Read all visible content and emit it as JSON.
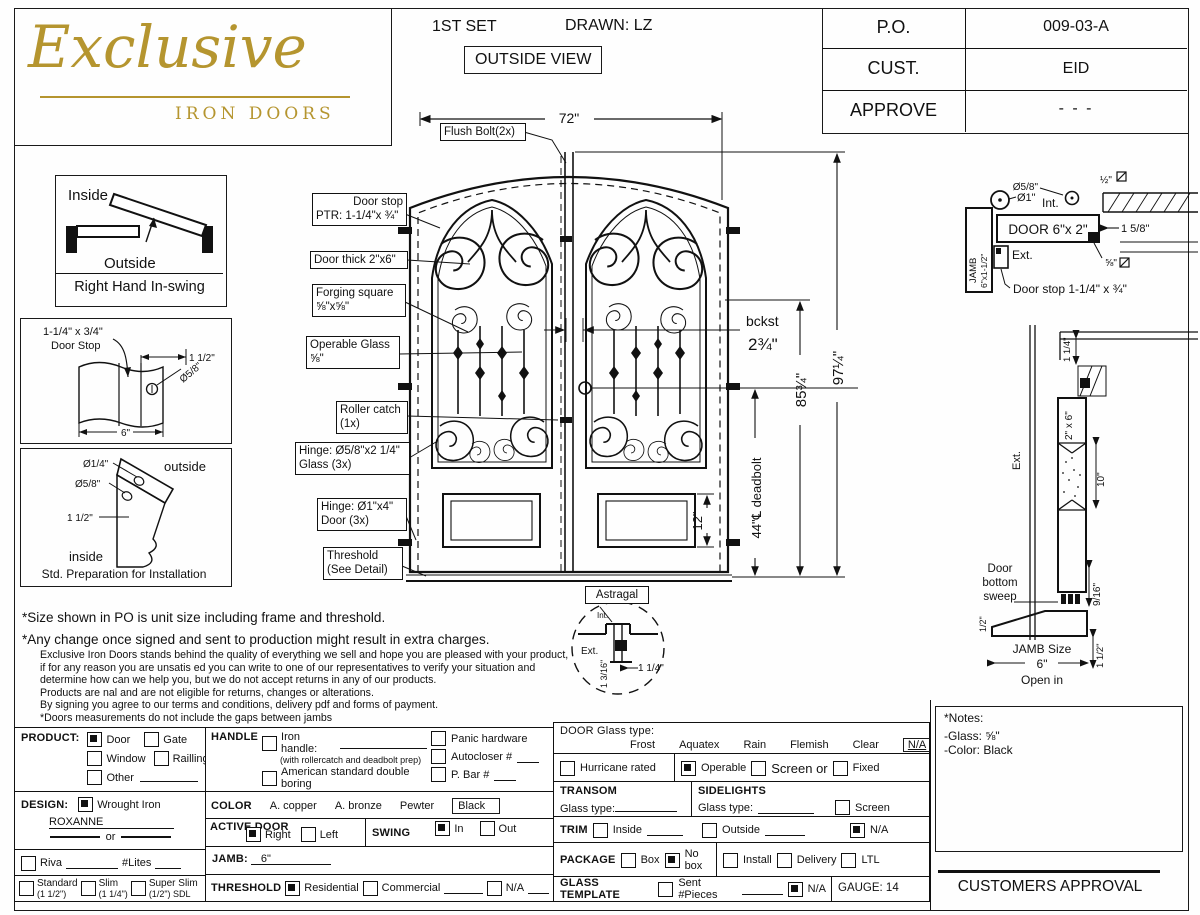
{
  "header": {
    "logo_line1": "Exclusive",
    "logo_line2": "IRON DOORS",
    "set_label": "1ST SET",
    "drawn_label": "DRAWN: LZ",
    "view_label": "OUTSIDE VIEW",
    "table": {
      "r1_label": "P.O.",
      "r1_value": "009-03-A",
      "r2_label": "CUST.",
      "r2_value": "EID",
      "r3_label": "APPROVE",
      "r3_value": "- - -"
    }
  },
  "swing_box": {
    "inside": "Inside",
    "outside": "Outside",
    "caption": "Right Hand In-swing"
  },
  "doorstop_detail": {
    "line1": "1-1/4\" x 3/4\"",
    "line2": "Door Stop",
    "dim_height": "1 1/2\"",
    "dim_hole": "Ø5/8\"",
    "dim_width": "6\""
  },
  "install_detail": {
    "dim1": "Ø1/4\"",
    "dim2": "Ø5/8\"",
    "dim3": "1 1/2\"",
    "outside": "outside",
    "inside": "inside",
    "caption": "Std. Preparation for Installation"
  },
  "door": {
    "labels": {
      "flush_bolt": "Flush Bolt(2x)",
      "door_stop1": "Door stop",
      "door_stop2": "PTR: 1-1/4\"x ¾\"",
      "door_thick": "Door thick 2\"x6\"",
      "forging1": "Forging square",
      "forging2": "⅝\"x⅝\"",
      "operable1": "Operable Glass",
      "operable2": "⅝\"",
      "roller1": "Roller catch",
      "roller2": "(1x)",
      "hinge_glass1": "Hinge: Ø5/8\"x2 1/4\"",
      "hinge_glass2": "Glass (3x)",
      "hinge_door1": "Hinge: Ø1\"x4\"",
      "hinge_door2": "Door (3x)",
      "threshold1": "Threshold",
      "threshold2": "(See Detail)",
      "astragal": "Astragal"
    },
    "dims": {
      "width": "72\"",
      "height_unit": "97¼\"",
      "height_door": "85¾\"",
      "deadbolt": "44\"℄ deadbolt",
      "panel": "12\"",
      "backset1": "bckst",
      "backset2": "2¾\""
    },
    "astragal_detail": {
      "int": "Int.",
      "ext": "Ext.",
      "dim_v": "1 3/16\"",
      "dim_h": "1 1/4\""
    }
  },
  "head_detail": {
    "hinge_dia": "Ø1\"",
    "int": "Int.",
    "peep": "Ø5/8\"",
    "half": "½\"",
    "door_label": "DOOR 6\"x 2\"",
    "dim": "1 5/8\"",
    "seal": "⅝\"",
    "jamb1": "JAMB",
    "jamb2": "6\"x1-1/2\"",
    "ext": "Ext.",
    "door_stop": "Door stop 1-1/4\" x ¾\""
  },
  "section_detail": {
    "top_dim": "1 1/4\"",
    "door_dim": "2\" x 6\"",
    "glass_dim": "10\"",
    "ext": "Ext.",
    "sweep_dim": "9/16\"",
    "sweep1": "Door",
    "sweep2": "bottom",
    "sweep3": "sweep",
    "half": "1/2\"",
    "jamb_size1": "JAMB Size",
    "jamb_size2": "6\"",
    "open_in": "Open in",
    "threshold_h": "1 1/2\""
  },
  "notes": {
    "line1": "*Size shown in PO is unit size including frame and threshold.",
    "line2": "*Any change once signed and sent to production might result in extra charges.",
    "body": [
      "Exclusive Iron Doors stands behind the quality of everything we sell and hope you are pleased with your product,",
      "if for any reason you are unsatis  ed you can write to one of our representatives to verify your situation and",
      "determine how can we help you, but we do not accept returns in any of our products.",
      "Products are  nal and are not eligible for returns, changes or alterations.",
      "By signing you agree to our terms and conditions, delivery pdf and forms of payment.",
      "*Doors measurements do not include the gaps between jambs"
    ]
  },
  "form": {
    "product": {
      "label": "PRODUCT:",
      "door": "Door",
      "gate": "Gate",
      "window": "Window",
      "railling": "Railling",
      "other": "Other"
    },
    "design": {
      "label": "DESIGN:",
      "opt": "Wrought Iron",
      "name": "ROXANNE",
      "or": "or"
    },
    "riva": {
      "label": "Riva",
      "lites": "#Lites"
    },
    "sdl": {
      "standard1": "Standard",
      "standard2": "(1 1/2\")",
      "slim1": "Slim",
      "slim2": "(1 1/4\")",
      "super1": "Super Slim",
      "super2": "(1/2\") SDL"
    },
    "handle": {
      "label": "HANDLE",
      "iron": "Iron handle:",
      "iron_note": "(with rollercatch and deadbolt prep)",
      "american": "American standard double boring",
      "other": "Other:",
      "other_val": "N/A",
      "panic": "Panic hardware",
      "autocloser": "Autocloser #",
      "pbar": "P. Bar #"
    },
    "color": {
      "label": "COLOR",
      "copper": "A. copper",
      "bronze": "A. bronze",
      "pewter": "Pewter",
      "black": "Black"
    },
    "active_door": {
      "label": "ACTIVE DOOR",
      "right": "Right",
      "left": "Left"
    },
    "swing": {
      "label": "SWING",
      "in": "In",
      "out": "Out"
    },
    "jamb": {
      "label": "JAMB:",
      "value": "6\""
    },
    "threshold": {
      "label": "THRESHOLD",
      "residential": "Residential",
      "commercial": "Commercial",
      "na": "N/A"
    },
    "glass": {
      "label": "DOOR Glass type:",
      "frost": "Frost",
      "aquatex": "Aquatex",
      "rain": "Rain",
      "flemish": "Flemish",
      "clear": "Clear",
      "na": "N/A"
    },
    "glass_row": {
      "hurricane": "Hurricane rated",
      "operable": "Operable",
      "screen_or": "Screen or",
      "fixed": "Fixed"
    },
    "transom": {
      "label": "TRANSOM",
      "glass_type": "Glass type:"
    },
    "sidelights": {
      "label": "SIDELIGHTS",
      "glass_type": "Glass type:",
      "screen": "Screen"
    },
    "trim": {
      "label": "TRIM",
      "inside": "Inside",
      "outside": "Outside",
      "na": "N/A"
    },
    "package": {
      "label": "PACKAGE",
      "box": "Box",
      "nobox": "No box",
      "install": "Install",
      "delivery": "Delivery",
      "ltl": "LTL"
    },
    "glass_template": {
      "label": "GLASS TEMPLATE",
      "sent": "Sent #Pieces",
      "na": "N/A"
    },
    "gauge": "GAUGE: 14",
    "notes_box": {
      "title": "*Notes:",
      "glass": "-Glass: ⅝\"",
      "color": "-Color: Black"
    },
    "approval": "CUSTOMERS APPROVAL"
  },
  "colors": {
    "gold": "#b5952f",
    "line": "#1a1a1a"
  }
}
